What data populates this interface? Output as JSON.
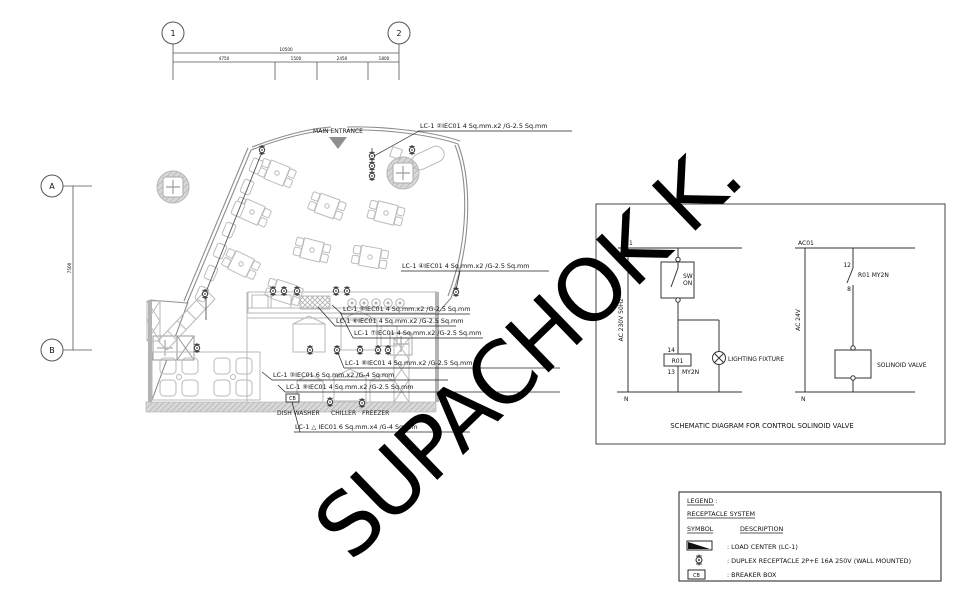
{
  "watermark": "SUPACHOK K.",
  "grid": {
    "col_bubbles": [
      "1",
      "2"
    ],
    "row_bubbles": [
      "A",
      "B"
    ],
    "dim_total": "10500",
    "dim_segments": [
      "4750",
      "1500",
      "2450",
      "1800"
    ],
    "dim_vertical": "7500"
  },
  "plan": {
    "entrance_label": "MAIN ENTRANCE",
    "breaker_box_label": "CB",
    "equipment_labels": {
      "dish_washer": "DISH WASHER",
      "chiller": "CHILLER",
      "freezer": "FREEZER"
    },
    "annotations": [
      {
        "text": "LC-1 ②IEC01 4 Sq.mm.x2 /G-2.5 Sq.mm"
      },
      {
        "text": "LC-1 ④IEC01 4 Sq.mm.x2 /G-2.5 Sq.mm"
      },
      {
        "text": "LC-1 ⑤IEC01 4 Sq.mm.x2 /G-2.5 Sq.mm"
      },
      {
        "text": "LC-1 ⑥IEC01 4 Sq.mm.x2 /G-2.5 Sq.mm"
      },
      {
        "text": "LC-1 ⑦IEC01 4 Sq.mm.x2 /G-2.5 Sq.mm"
      },
      {
        "text": "LC-1 ⑧IEC01 4 Sq.mm.x2 /G-2.5 Sq.mm"
      },
      {
        "text": "LC-1 ③IEC01 6 Sq.mm.x2 /G-4 Sq.mm"
      },
      {
        "text": "LC-1 ⑨IEC01 4 Sq.mm.x2 /G-2.5 Sq.mm"
      },
      {
        "text": "LC-1 △ IEC01 6 Sq.mm.x4 /G-4 Sq.mm"
      }
    ]
  },
  "schematic": {
    "title": "SCHEMATIC DIAGRAM FOR CONTROL SOLINOID VALVE",
    "left": {
      "bus_label": "R01",
      "voltage": "AC 230V 50Hz",
      "neutral": "N",
      "switch_line1": "SW",
      "switch_line2": "ON",
      "relay_pin_top": "14",
      "relay_label": "R01",
      "relay_pin_bottom": "13",
      "relay_type": "MY2N",
      "load_label": "LIGHTING FIXTURE"
    },
    "right": {
      "bus_label": "AC01",
      "voltage": "AC 24V",
      "neutral": "N",
      "contact_pin_top": "12",
      "contact_label": "R01 MY2N",
      "contact_pin_bottom": "8",
      "load_label": "SOLINOID VALVE"
    }
  },
  "legend": {
    "title": "LEGEND :",
    "system": "RECEPTACLE SYSTEM",
    "col_symbol": "SYMBOL",
    "col_description": "DESCRIPTION",
    "breaker_symbol_text": "CB",
    "rows": [
      {
        "desc": ": LOAD CENTER (LC-1)"
      },
      {
        "desc": ": DUPLEX RECEPTACLE 2P+E 16A 250V (WALL MOUNTED)"
      },
      {
        "desc": ": BREAKER BOX"
      }
    ]
  }
}
